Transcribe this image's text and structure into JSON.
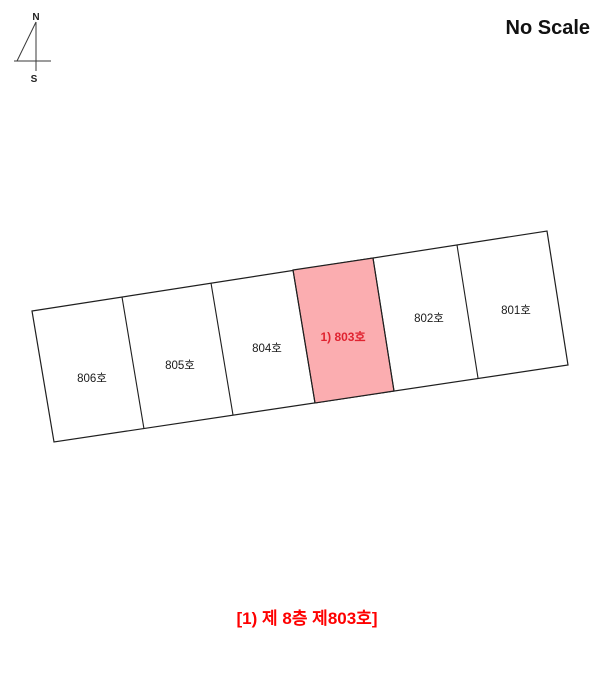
{
  "scale_note": "No Scale",
  "caption": "[1) 제 8층 제803호]",
  "compass": {
    "north_label": "N",
    "south_label": "S"
  },
  "floor_plan": {
    "units": [
      {
        "label": "806호",
        "highlighted": false
      },
      {
        "label": "805호",
        "highlighted": false
      },
      {
        "label": "804호",
        "highlighted": false
      },
      {
        "label": "1) 803호",
        "highlighted": true
      },
      {
        "label": "802호",
        "highlighted": false
      },
      {
        "label": "801호",
        "highlighted": false
      }
    ]
  },
  "colors": {
    "highlight_fill": "#fbadb0",
    "highlight_text": "#e02330",
    "caption_text": "#fe0000",
    "line": "#1f1f1f"
  }
}
